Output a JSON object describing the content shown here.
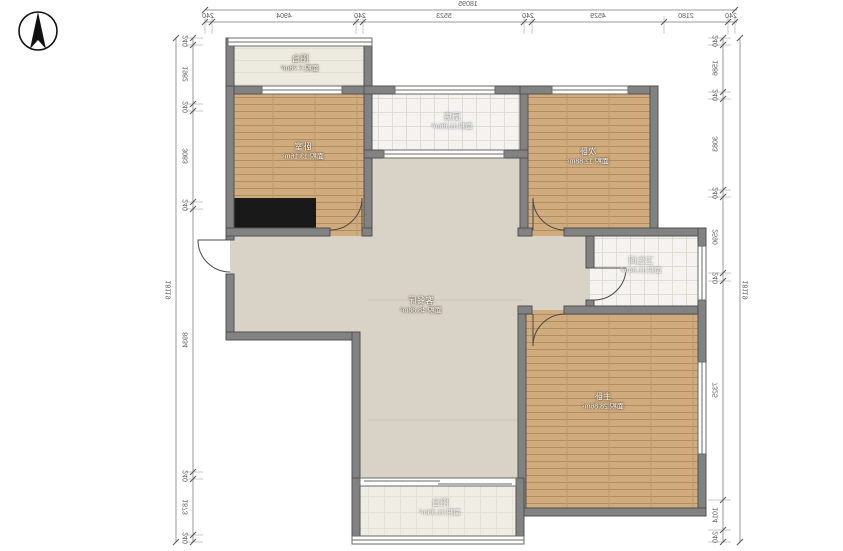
{
  "compass": {
    "icon": "north-arrow"
  },
  "rooms": [
    {
      "id": "balcony-top",
      "name": "阳台",
      "area": "面积:7.78m²"
    },
    {
      "id": "bedroom-left",
      "name": "卧室",
      "area": "面积:13.16m²"
    },
    {
      "id": "kitchen",
      "name": "厨房",
      "area": "面积:11.86m²"
    },
    {
      "id": "bedroom-right",
      "name": "次卧",
      "area": "面积:12.88m²"
    },
    {
      "id": "bathroom",
      "name": "卫生间",
      "area": "面积:11.84m²"
    },
    {
      "id": "living-dining",
      "name": "客餐厅",
      "area": "面积:48.88m²"
    },
    {
      "id": "master-bedroom",
      "name": "主卧",
      "area": "面积:28.86m²"
    },
    {
      "id": "balcony-bottom",
      "name": "阳台",
      "area": "面积:11.33m²"
    }
  ],
  "dimensions": {
    "top": {
      "total": "18095",
      "segments": [
        "240",
        "4904",
        "240",
        "5523",
        "240",
        "4529",
        "2180",
        "240"
      ]
    },
    "left": {
      "total": "18119",
      "segments": [
        "240",
        "1982",
        "240",
        "3083",
        "240",
        "8934",
        "240",
        "1873",
        "240"
      ]
    },
    "right": {
      "total": "18119",
      "segments": [
        "240",
        "1586",
        "240",
        "3083",
        "240",
        "2590",
        "240",
        "7325",
        "1014",
        "240"
      ]
    }
  },
  "colors": {
    "wall": "#828282",
    "wood_floor": "#cfab7e",
    "tile_floor": "#f4f3f0",
    "living_floor": "#d9d3c7",
    "balcony_floor": "#edeadf",
    "wardrobe": "#191919",
    "dimension_line": "#9a9a9a"
  }
}
